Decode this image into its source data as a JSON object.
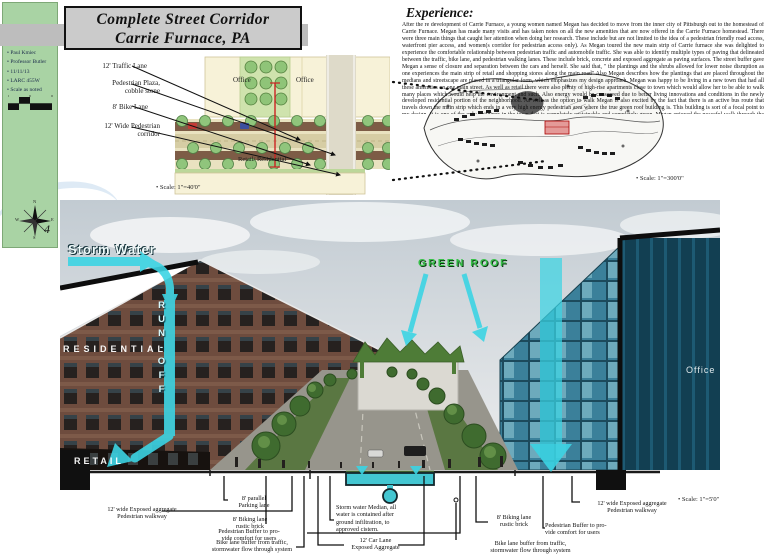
{
  "meta": {
    "page_number": "4"
  },
  "sidebar": {
    "items": [
      "Paul Kmiec",
      "Professor Butler",
      "11/11/13",
      "LARC 455W",
      "Scale as noted"
    ],
    "compass": {
      "n": "N",
      "e": "E",
      "s": "S",
      "w": "W"
    }
  },
  "title": {
    "line1": "Complete Street Corridor",
    "line2": "Carrie Furnace, PA"
  },
  "experience": {
    "heading": "Experience:",
    "paragraph": "After the re development of Carrie Furnace, a young women named Megan has decided to move from the inner city of Pittsburgh out to the homestead of Carrie Furnace. Megan has made many visits and has taken notes on all the new amenities that are now offered in the Carrie Furnace homestead. There were three main things that caught her attention when doing her research. These include but are not limited to the idea of a pedestrian friendly road access, waterfront pier access, and women(s corridor for pedestrian access only). As Megan toured the new main strip of Carrie furnace she was delighted to experience the comfortable relationship between pedestrian traffic and automobile traffic. She was able to identify multiple types of paving that delineated between the traffic, bike lane, and pedestrian walking lanes. These include brick, concrete and exposed aggregate as paving surfaces. The street buffer gave Megan a sense of closure and separation between the cars and herself. She said that, \" the plantings and the shrubs allowed for lower noise disruption as one experiences the main strip of retail and shopping stores along the main road\" Also Megan describes how the plantings that are placed throughout the medians and streetscape are placed in a triangular form, which emphasizes my design approach. Megan was happy to be living in a new town that had all these amenities on one main street. As well as retail there were also plenty of high-rise apartments close to town which would allow her to be able to walk many places which would help the environment and such. Also energy would be conserved due to better living innovations and conditions in the newly developed residential portion of the neighborhood. As well as the option to walk Megan is also excited by the fact that there is an active bus route that travels down the main strip which ends in a very high energy pedestrian area where the true green roof building is. This building is sort of a focal point to my design. It is one of the only buildings in the town that is completely sustainable and completely green. Megan enjoyed the peaceful walk through the complete street on the main strip which had a soft transition from walkable traffic to all pedestrian traffic. This allowed for the transition between these to places to be smooth and user friendly for both Megan and others on foot."
  },
  "plan": {
    "labels": [
      "12' Traffic Lane",
      "Pedestrian Plaza,\ncobble stone",
      "8' Bike Lane",
      "12' Wide Pedestrian\ncorridor"
    ],
    "office_1": "Office",
    "office_2": "Office",
    "retail": "Retail/ Residential",
    "scale": "• Scale: 1\"=40'0\""
  },
  "site_plan": {
    "scale": "• Scale: 1\"=300'0\""
  },
  "render": {
    "storm_water": "Storm Water",
    "run_off": "RUN-OFF",
    "residential": "RESIDENTIAL",
    "retail": "RETAIL",
    "green_roof": "GREEN ROOF",
    "office": "Office",
    "scale": "• Scale: 1\"=5'0\""
  },
  "section_labels": [
    {
      "text": "12' wide Exposed aggregate\nPedestrian walkway"
    },
    {
      "text": "Pedestrian Buffer to pro-\nvide comfort for users"
    },
    {
      "text": "8' parallel\nParking lane"
    },
    {
      "text": "8' Biking lane\nrustic brick"
    },
    {
      "text": "Bike lane buffer from traffic,\nstormwater flow through system"
    },
    {
      "text": "Storm water Median, all\nwater is contained after\nground infiltration, to\napproved cistern."
    },
    {
      "text": "12' Car Lane\nExposed Aggregate"
    },
    {
      "text": "8' Biking lane\nrustic brick"
    },
    {
      "text": "Bike lane buffer from traffic,\nstormwater flow through system"
    },
    {
      "text": "Pedestrian Buffer to pro-\nvide comfort for users"
    },
    {
      "text": "12' wide Exposed aggregate\nPedestrian walkway"
    }
  ],
  "colors": {
    "sidebar_green": "#a9d3a4",
    "cyan": "#3bd4e4",
    "title_gray": "#cbcbcb",
    "plan_tan": "#e9e2c0",
    "lane_brown": "#7d5c46",
    "tree_green": "#90c57c",
    "red_accent": "#cc2222"
  }
}
